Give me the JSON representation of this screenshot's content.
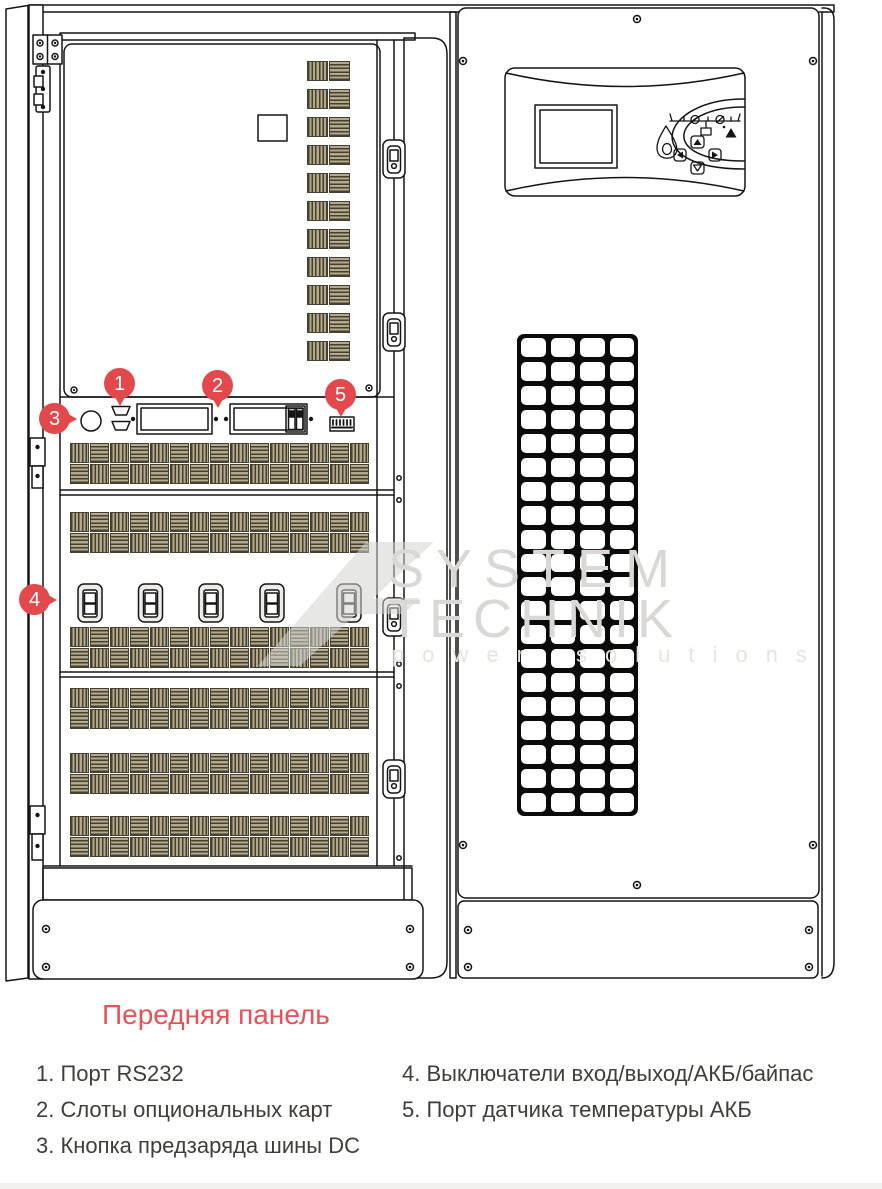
{
  "title": {
    "text": "Передняя панель"
  },
  "markers": [
    "1",
    "2",
    "3",
    "4",
    "5"
  ],
  "legend": {
    "left": [
      "1. Порт RS232",
      "2. Слоты опциональных карт",
      "3. Кнопка предзаряда шины DC"
    ],
    "right": [
      "4. Выключатели вход/выход/АКБ/байпас",
      "5. Порт датчика температуры АКБ"
    ]
  },
  "watermark": {
    "line1": "SYSTEM",
    "line2": "TECHNIK",
    "tagline": "power solutions"
  },
  "colors": {
    "marker_red": "#e2484c",
    "title_red": "#ea5257",
    "vent_dark": "#46402f",
    "vent_khaki": "#b3aa8e",
    "grille_black": "#0a0a0a",
    "watermark_gray": "#d9d8d6",
    "line_art": "#151515"
  }
}
